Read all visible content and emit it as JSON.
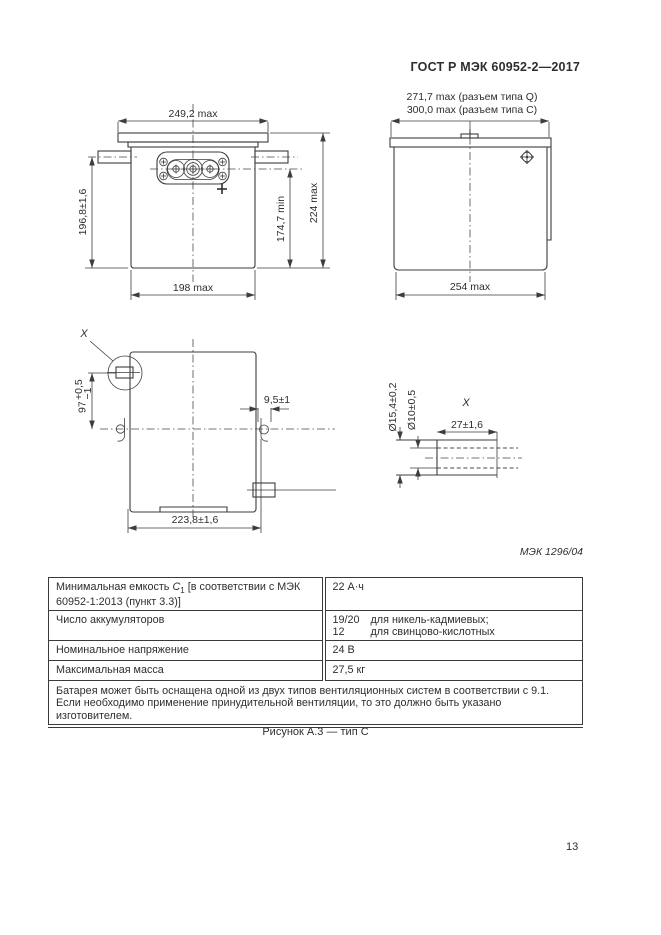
{
  "header": {
    "title": "ГОСТ Р МЭК 60952-2—2017"
  },
  "drawing_ref": "МЭК 1296/04",
  "figure_caption": "Рисунок А.3 — тип С",
  "page_number": "13",
  "front_view": {
    "dim_flange_width": "249,2 max",
    "dim_mount_height": "196,8±1,6",
    "dim_terminal_height": "174,7 min",
    "dim_total_height": "224 max",
    "dim_body_width": "198 max"
  },
  "side_view": {
    "dim_width_q": "271,7 max (разъем типа Q)",
    "dim_width_c": "300,0 max (разъем типа C)",
    "dim_body_depth": "254 max"
  },
  "top_view": {
    "detail_marker": "X",
    "dim_offset_value": "97",
    "dim_offset_sup": "+0,5",
    "dim_offset_sub": "−1",
    "dim_lug_width": "9,5±1",
    "dim_body_depth": "223,8±1,6"
  },
  "detail_x": {
    "label": "X",
    "dim_outer_dia": "Ø15,4±0,2",
    "dim_inner_dia": "Ø10±0,5",
    "dim_length": "27±1,6"
  },
  "spec_table": {
    "rows": [
      {
        "label_pre": "Минимальная емкость ",
        "label_symbol": "C",
        "label_subscript": "1",
        "label_post": " [в соответствии с МЭК 60952-1:2013 (пункт 3.3)]",
        "value": "22 А·ч"
      },
      {
        "label": "Число аккумуляторов",
        "value_lines": [
          {
            "num": "19/20",
            "text": "для никель-кадмиевых;"
          },
          {
            "num": "12",
            "text": "для свинцово-кислотных"
          }
        ]
      },
      {
        "label": "Номинальное напряжение",
        "value": "24 В"
      },
      {
        "label": "Максимальная масса",
        "value": "27,5 кг"
      }
    ],
    "note": "Батарея может быть оснащена одной из двух типов вентиляционных систем в соответствии с 9.1. Если необходимо применение принудительной вентиляции, то это должно быть указано изготовителем."
  }
}
